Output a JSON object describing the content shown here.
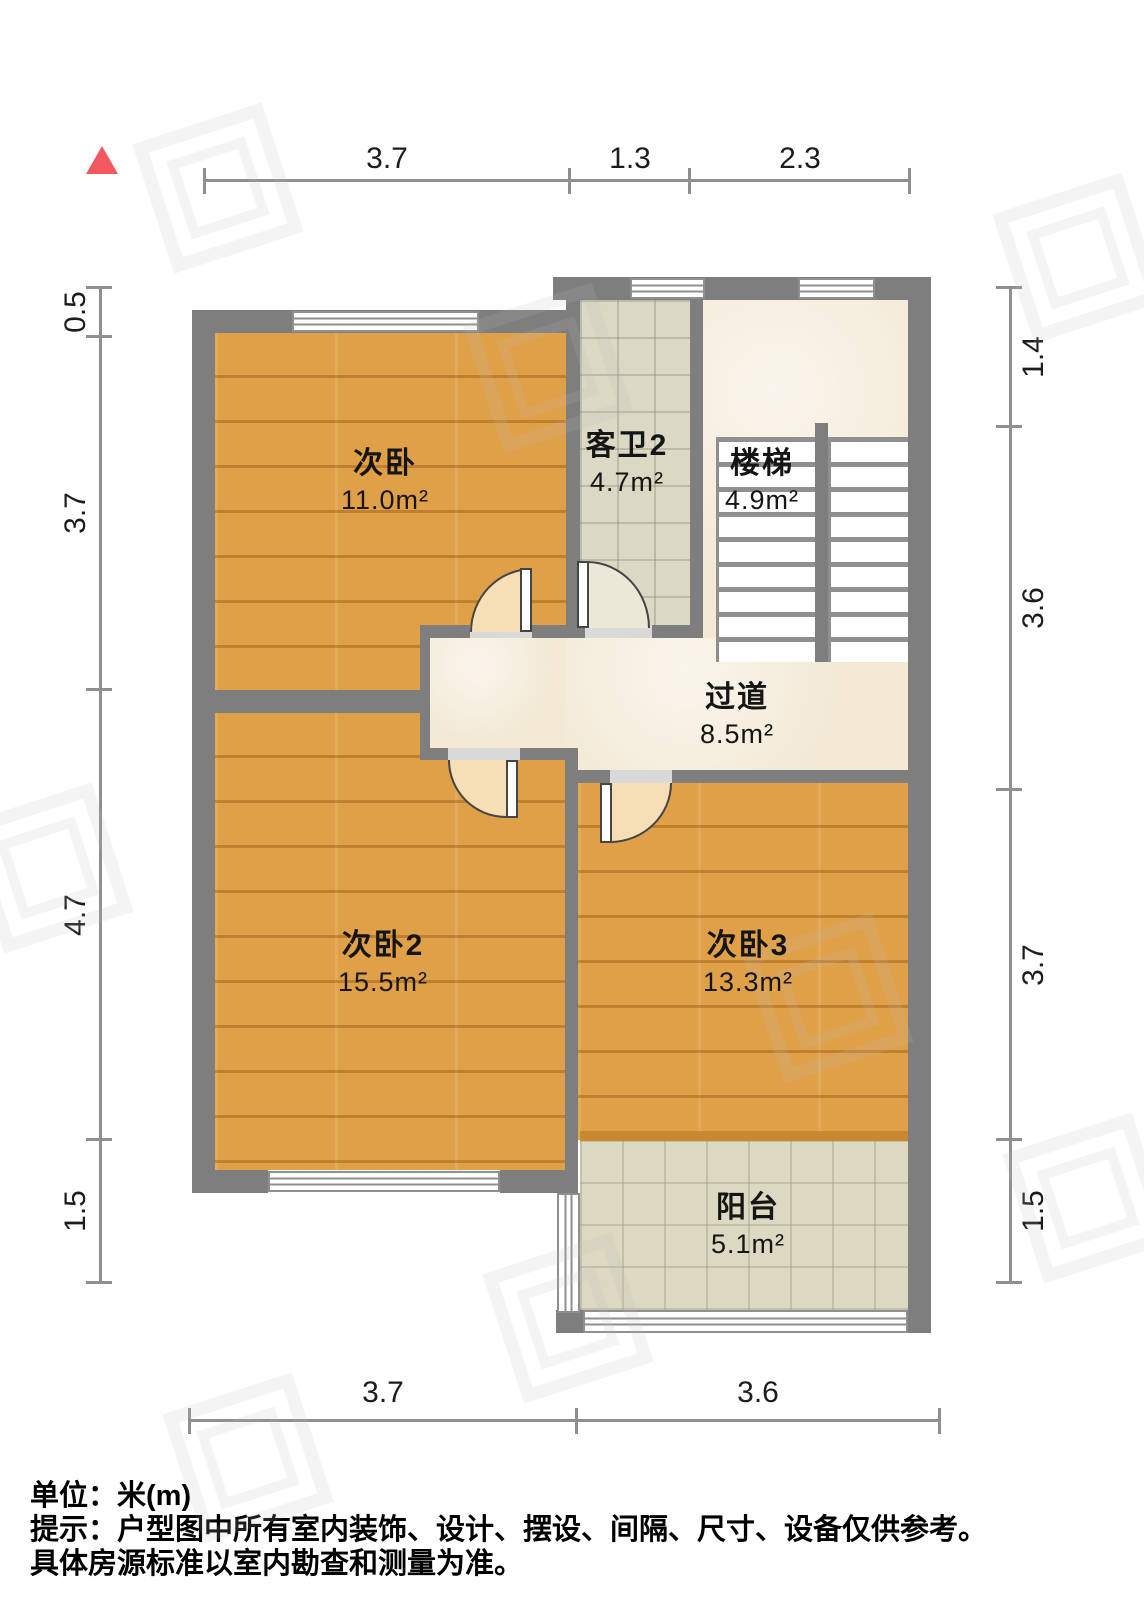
{
  "rooms": [
    {
      "name": "次卧",
      "area": "11.0m²"
    },
    {
      "name": "客卫2",
      "area": "4.7m²"
    },
    {
      "name": "楼梯",
      "area": "4.9m²"
    },
    {
      "name": "过道",
      "area": "8.5m²"
    },
    {
      "name": "次卧2",
      "area": "15.5m²"
    },
    {
      "name": "次卧3",
      "area": "13.3m²"
    },
    {
      "name": "阳台",
      "area": "5.1m²"
    }
  ],
  "dimensions": {
    "top": [
      "3.7",
      "1.3",
      "2.3"
    ],
    "bottom": [
      "3.7",
      "3.6"
    ],
    "left": [
      "0.5",
      "3.7",
      "4.7",
      "1.5"
    ],
    "right": [
      "1.4",
      "3.6",
      "3.7",
      "1.5"
    ]
  },
  "notes": {
    "unit": "单位：米(m)",
    "tip1": "提示：户型图中所有室内装饰、设计、摆设、间隔、尺寸、设备仅供参考。",
    "tip2": "具体房源标准以室内勘查和测量为准。"
  },
  "colors": {
    "wall": "#7E7E7E",
    "wood": "#E0A048",
    "wood_dark": "#C9882F",
    "bath_tile": "#DBD8C4",
    "marble": "#F3E9D5",
    "balcony_tile": "#DCD8C2",
    "door_wood": "#F6DFB6",
    "door_tile": "#ECE8D8",
    "north": "#F2595F",
    "dim_line": "#8F8F8F",
    "text": "#1A1A1A"
  }
}
